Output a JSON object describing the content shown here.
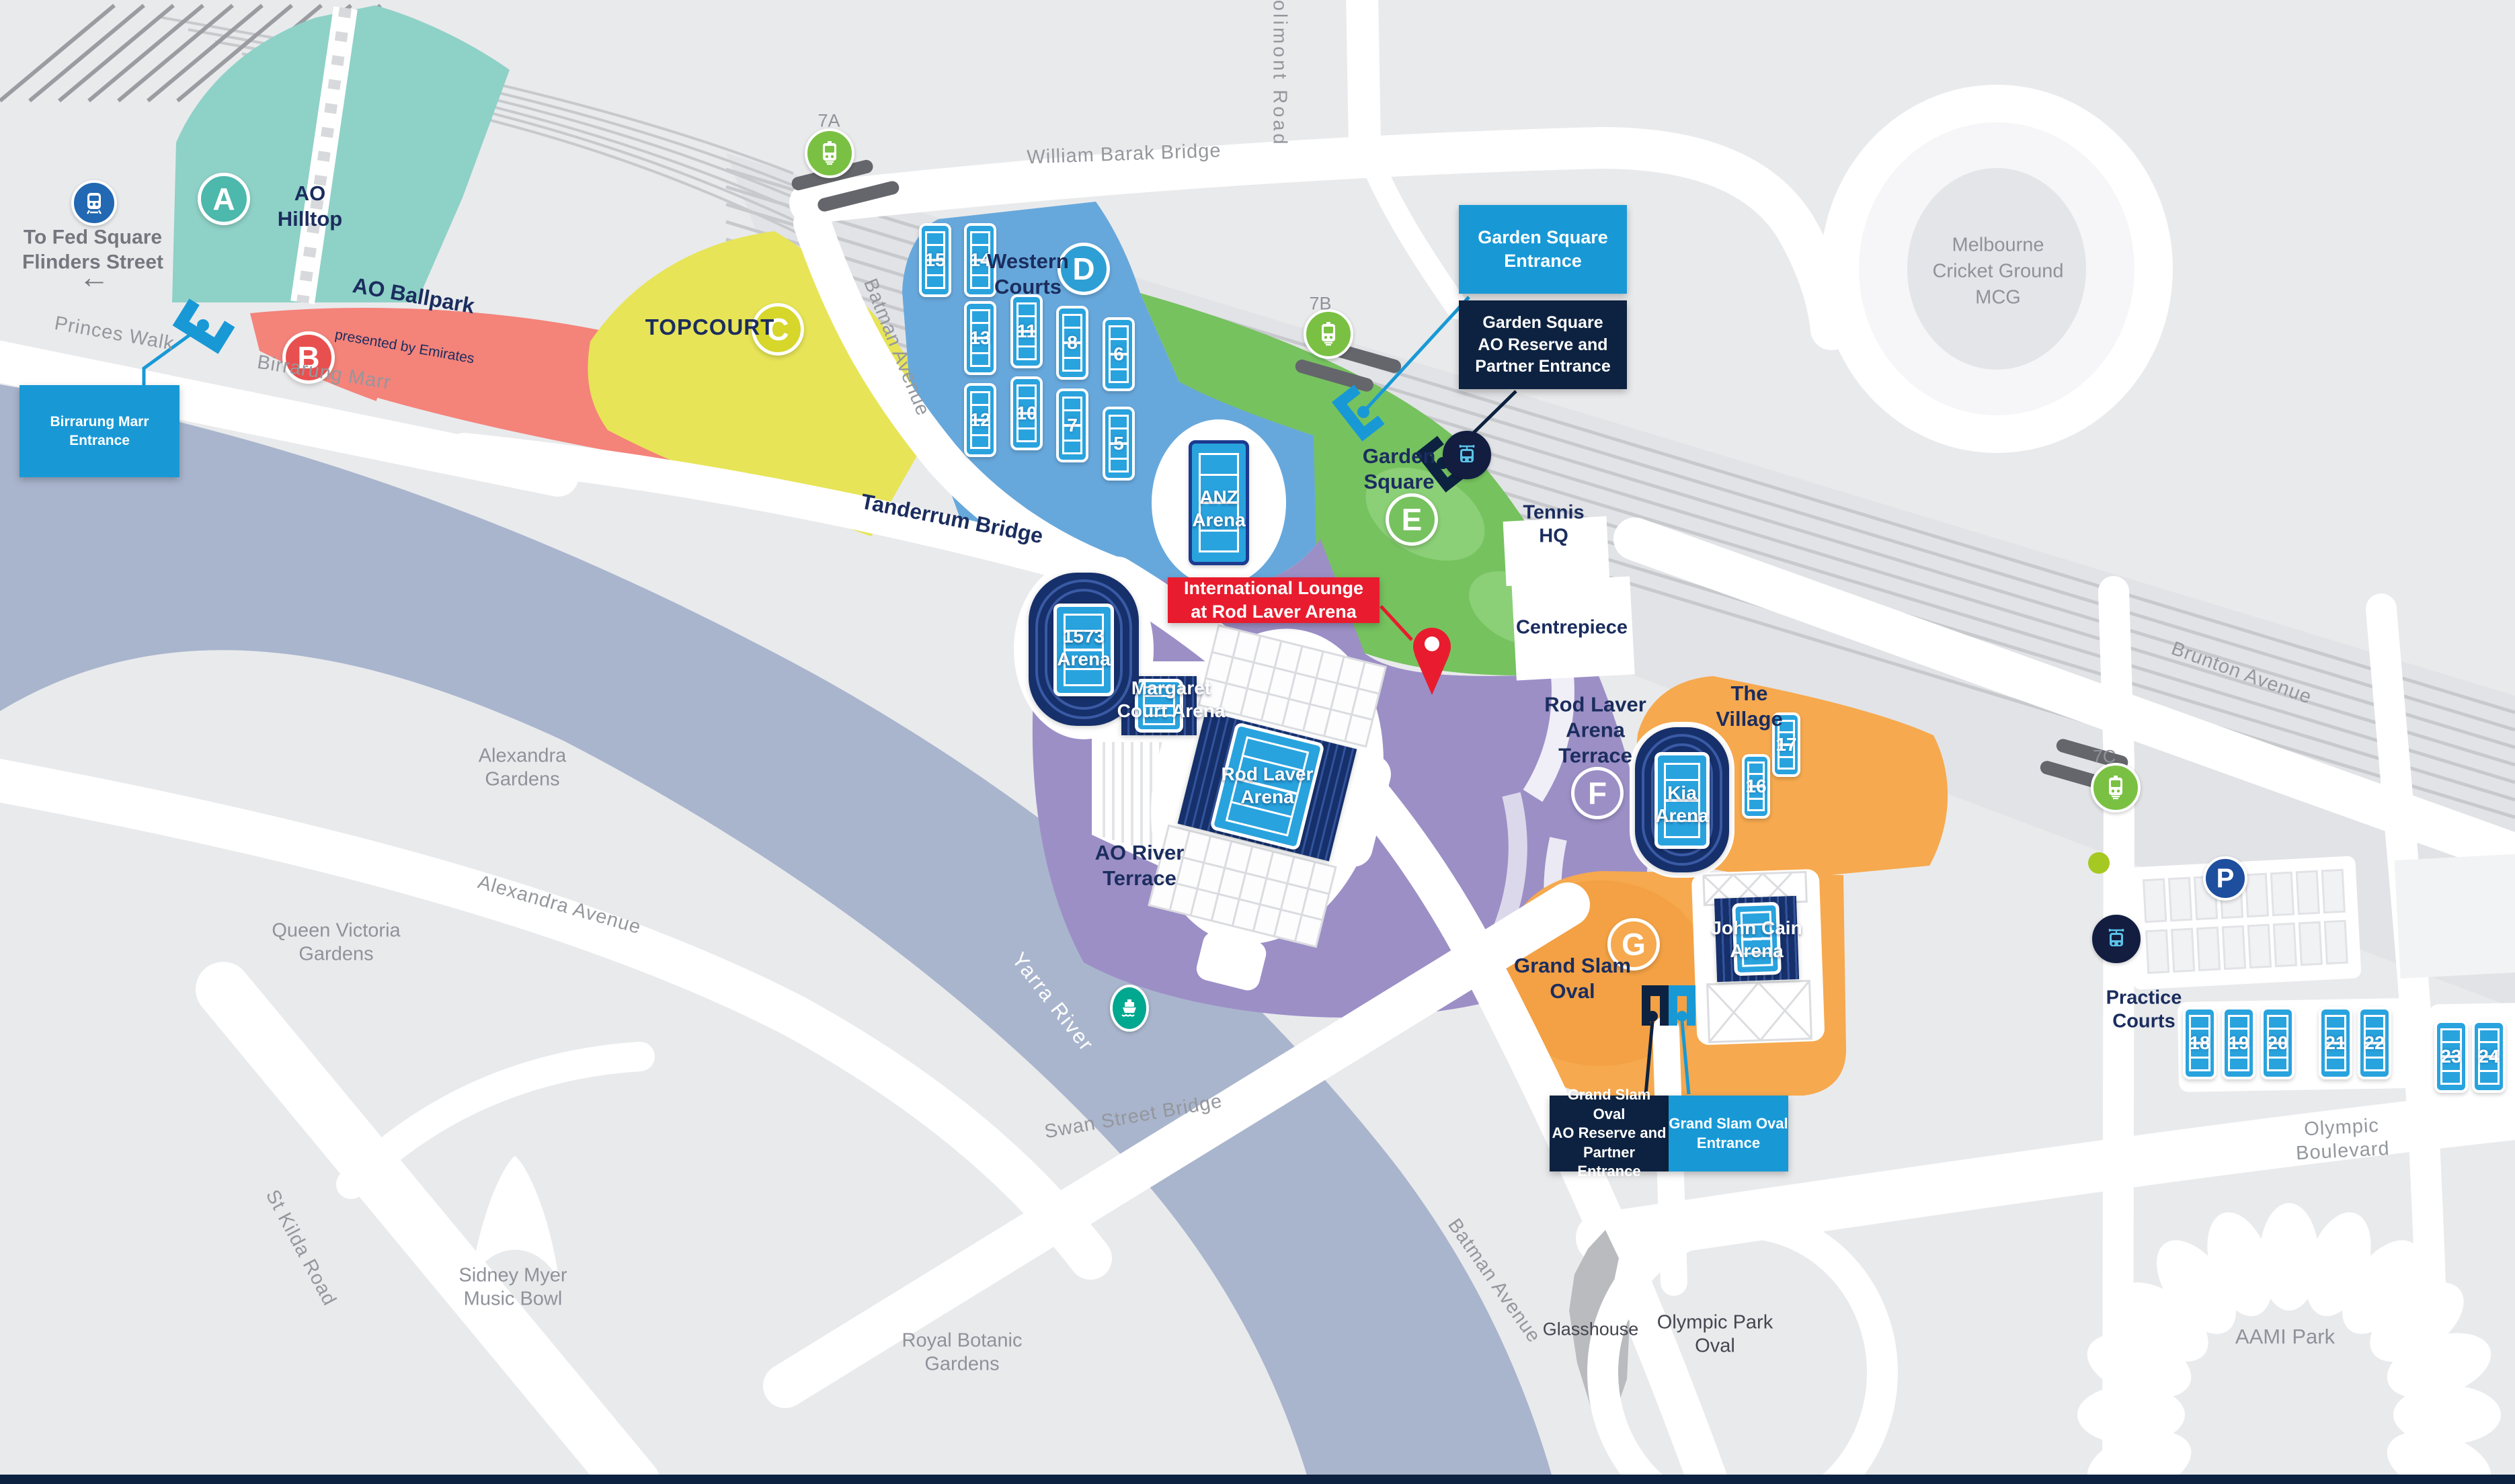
{
  "colors": {
    "background": "#e9eaec",
    "road": "#ffffff",
    "river": "#a9b5cd",
    "rail_line": "#c7c9cd",
    "navy_text": "#1b2d5e",
    "gray_text": "#94979d",
    "entrance_blue": "#1899d6",
    "entrance_navy": "#0d2240",
    "highlight_red": "#e81c2e",
    "zone_a_teal": "#8ed1c7",
    "zone_b_salmon": "#f4837a",
    "zone_c_yellow": "#e7e457",
    "zone_d_blue": "#67a8dc",
    "zone_e_green": "#76c25f",
    "zone_f_purple": "#9c8fc6",
    "zone_g_orange": "#f6a94e",
    "court_blue": "#29a3de",
    "arena_navy": "#16306b",
    "tram_green": "#7ac143",
    "train_blue": "#2268b2",
    "ferry_teal": "#00a88f",
    "parking_blue": "#1d4f9e",
    "bus_lightblue": "#5bc2e7"
  },
  "zones": {
    "a": "A",
    "b": "B",
    "c": "C",
    "d": "D",
    "e": "E",
    "f": "F",
    "g": "G"
  },
  "transport": {
    "stop_7a": "7A",
    "stop_7b": "7B",
    "stop_7c": "7C",
    "parking_label": "P",
    "icons": [
      "train-icon",
      "tram-icon",
      "bus-icon",
      "ferry-icon",
      "parking-icon"
    ]
  },
  "courts": {
    "western": [
      "15",
      "14",
      "13",
      "11",
      "8",
      "6",
      "12",
      "10",
      "7",
      "5"
    ],
    "village": [
      "17",
      "16"
    ],
    "practice": [
      "18",
      "19",
      "20",
      "21",
      "22",
      "23",
      "24"
    ]
  },
  "entrances": {
    "birrarung": "Birrarung Marr Entrance",
    "garden_square": "Garden Square\nEntrance",
    "garden_square_reserve": "Garden Square\nAO Reserve and\nPartner Entrance",
    "grand_slam_reserve": "Grand Slam Oval\nAO Reserve and\nPartner Entrance",
    "grand_slam": "Grand Slam Oval\nEntrance"
  },
  "highlight": {
    "international_lounge": "International Lounge\nat Rod Laver Arena"
  },
  "venues": {
    "anz": "ANZ\nArena",
    "arena_1573": "1573\nArena",
    "mca": "Margaret\nCourt Arena",
    "rla": "Rod Laver\nArena",
    "kia": "Kia\nArena",
    "jca": "John Cain\nArena",
    "mcg": "Melbourne\nCricket Ground\nMCG",
    "tennis_hq": "Tennis\nHQ",
    "centrepiece": "Centrepiece",
    "glasshouse": "Glasshouse",
    "olympic_park_oval": "Olympic Park\nOval",
    "aami_park": "AAMI Park",
    "sidney_myer": "Sidney Myer\nMusic Bowl"
  },
  "areas": {
    "ao_hilltop": "AO\nHilltop",
    "ao_ballpark": "AO Ballpark",
    "ao_ballpark_sub": "presented by Emirates",
    "topcourt": "TOPCOURT",
    "western_courts": "Western\nCourts",
    "garden_square": "Garden\nSquare",
    "rla_terrace": "Rod Laver\nArena\nTerrace",
    "ao_river_terrace": "AO River\nTerrace",
    "the_village": "The\nVillage",
    "grand_slam_oval": "Grand Slam\nOval",
    "practice_courts": "Practice\nCourts",
    "alexandra_gardens": "Alexandra\nGardens",
    "queen_victoria_gardens": "Queen Victoria\nGardens",
    "royal_botanic_gardens": "Royal Botanic\nGardens",
    "birrarung_marr": "Birrarung Marr"
  },
  "roads": {
    "princes_walk": "Princes Walk",
    "william_barak_bridge": "William Barak Bridge",
    "jolimont_road": "Jolimont Road",
    "batman_avenue": "Batman Avenue",
    "tanderrum_bridge": "Tanderrum Bridge",
    "swan_street_bridge": "Swan Street Bridge",
    "alexandra_avenue": "Alexandra Avenue",
    "st_kilda_road": "St Kilda Road",
    "yarra_river": "Yarra River",
    "olympic_boulevard": "Olympic Boulevard",
    "brunton_avenue": "Brunton Avenue"
  },
  "misc": {
    "to_fed_square": "To Fed Square\nFlinders Street",
    "arrow_left": "←"
  }
}
